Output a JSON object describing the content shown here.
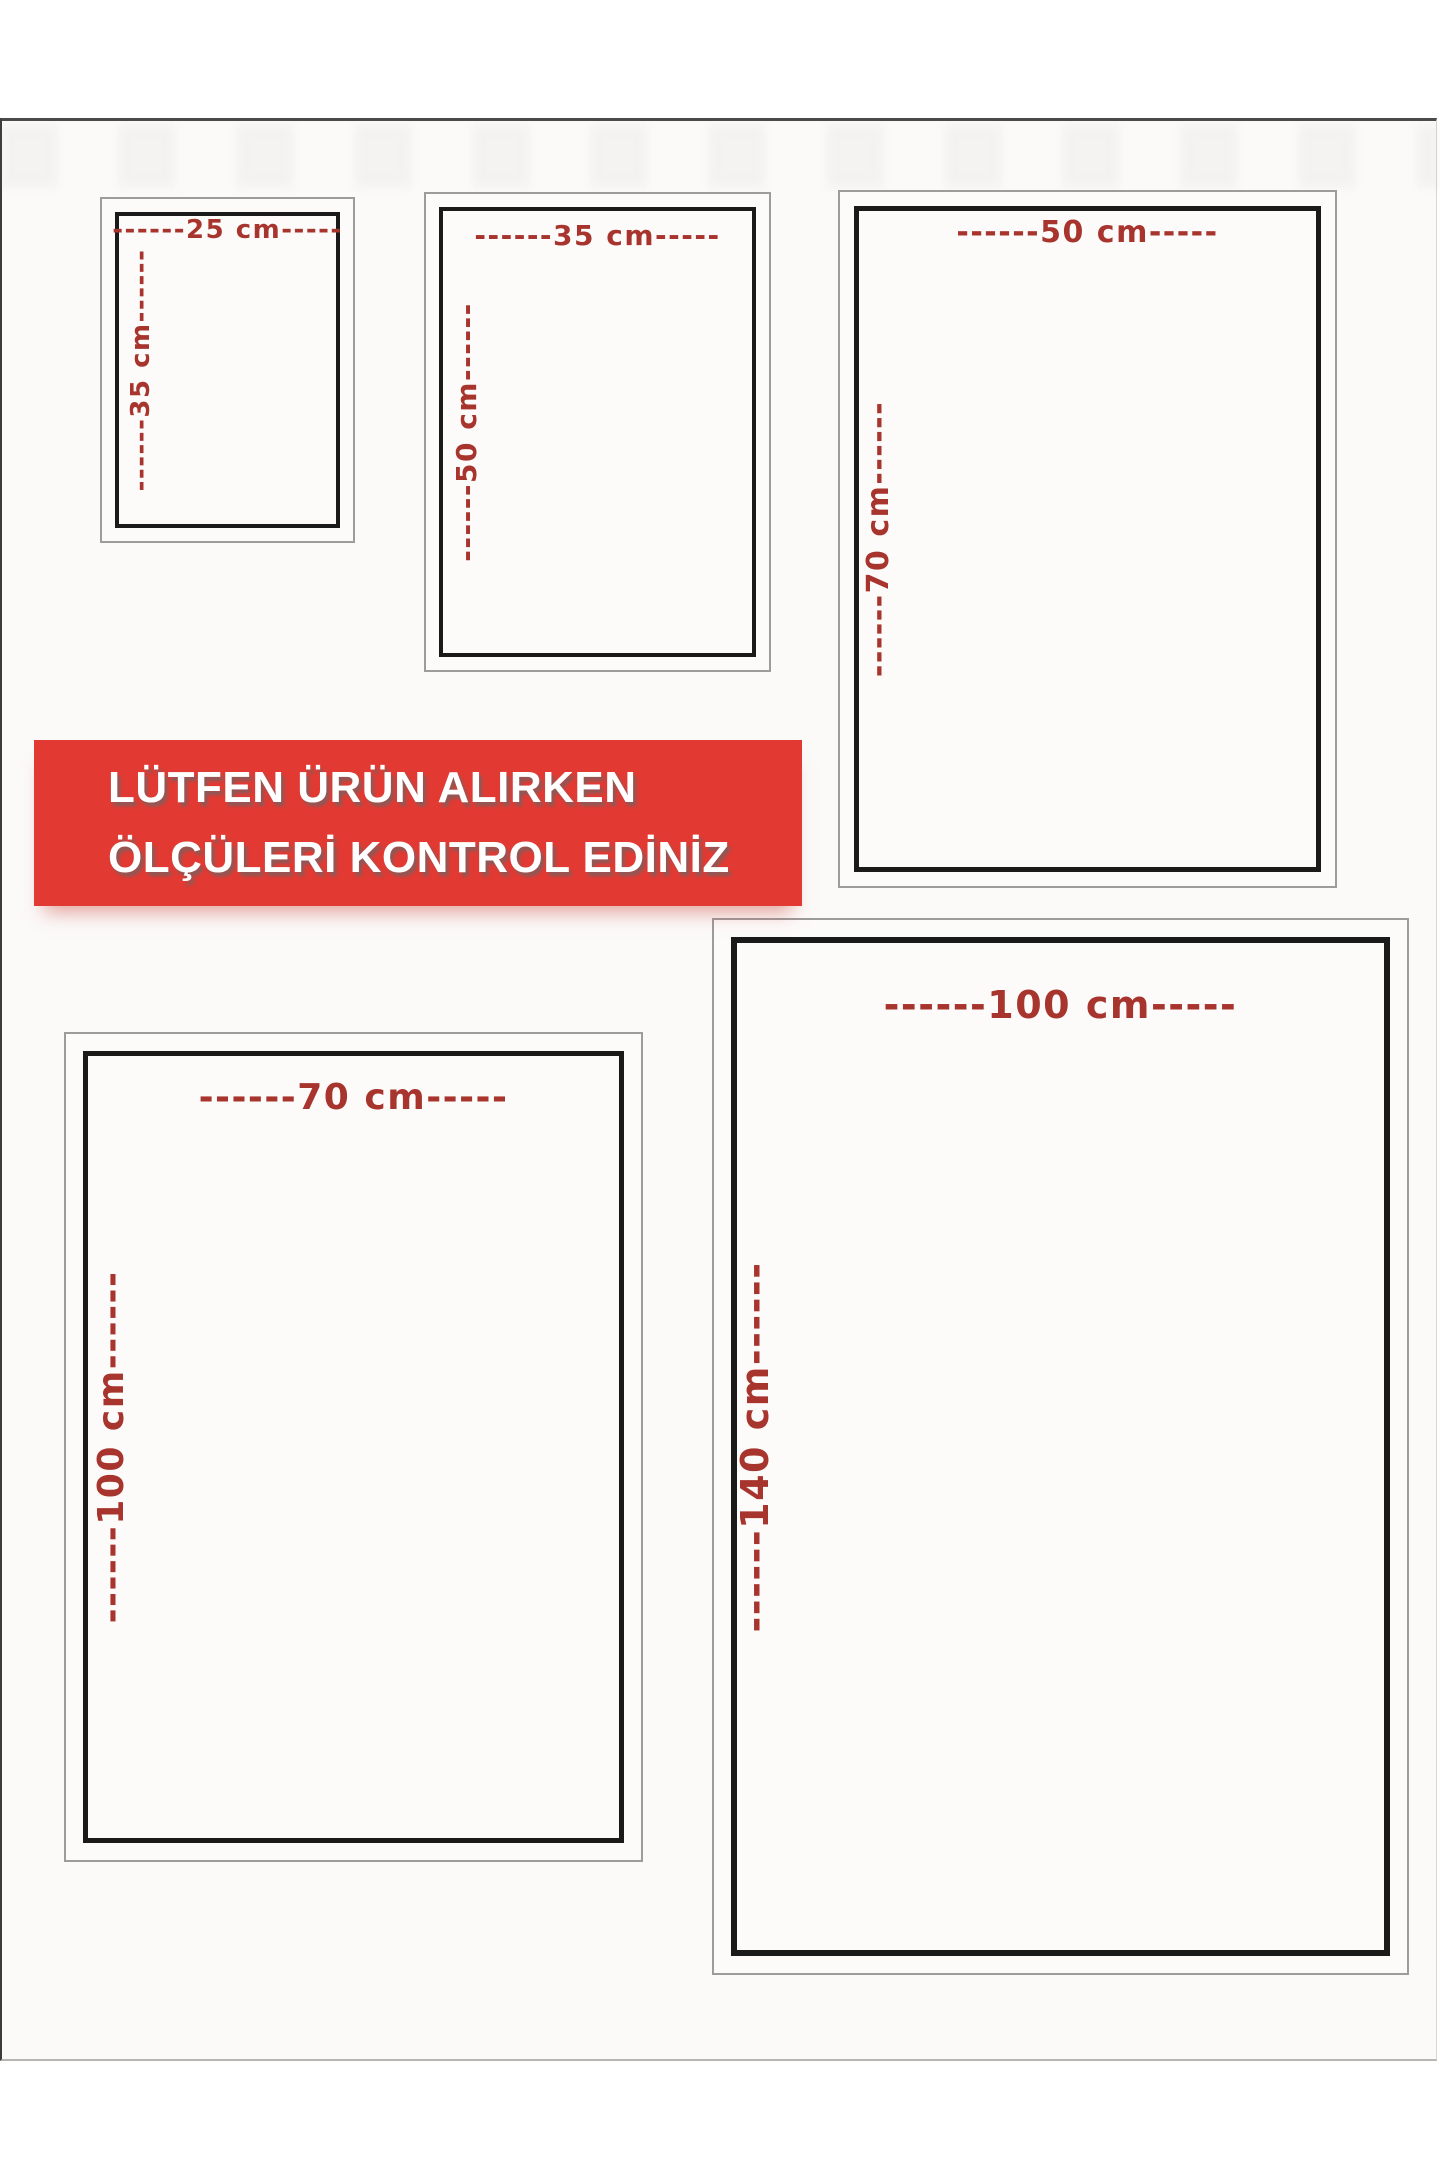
{
  "banner": {
    "line1": "LÜTFEN ÜRÜN ALIRKEN",
    "line2": "ÖLÇÜLERİ KONTROL EDİNİZ"
  },
  "sizes": [
    {
      "name": "25x35",
      "width_cm": 25,
      "height_cm": 35,
      "width_label": "------25 cm-----",
      "height_label": "------35 cm------"
    },
    {
      "name": "35x50",
      "width_cm": 35,
      "height_cm": 50,
      "width_label": "------35 cm-----",
      "height_label": "------50 cm------"
    },
    {
      "name": "50x70",
      "width_cm": 50,
      "height_cm": 70,
      "width_label": "------50 cm-----",
      "height_label": "------70 cm------"
    },
    {
      "name": "70x100",
      "width_cm": 70,
      "height_cm": 100,
      "width_label": "------70 cm-----",
      "height_label": "------100 cm------"
    },
    {
      "name": "100x140",
      "width_cm": 100,
      "height_cm": 140,
      "width_label": "------100 cm-----",
      "height_label": "------140 cm------"
    }
  ],
  "colors": {
    "banner_bg": "#e23a33",
    "banner_text": "#ffffff",
    "dimension_text": "#a8342e",
    "inner_border": "#1a1a1a",
    "outer_border": "#9c9c9c",
    "page_bg": "#fbfaf9"
  }
}
